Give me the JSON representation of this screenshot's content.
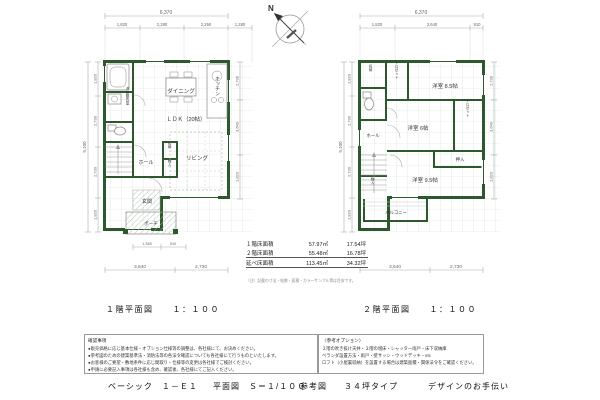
{
  "compass": {
    "label": "N"
  },
  "plan1": {
    "caption": "１階平面図　　１：１００",
    "rooms": {
      "dining": "ダイニング",
      "kitchen": "キッチン",
      "ldk": "ＬＤＫ（20帖）",
      "living": "リビング",
      "hall": "ホール",
      "entrance": "玄関",
      "porch": "ポーチ",
      "washroom": "洗面脱衣室",
      "storage1": "収納",
      "storage2": "物入"
    },
    "dims": {
      "top_total": "6,370",
      "top": [
        "1,820",
        "2,280",
        "2,250",
        "1,280"
      ],
      "left_total": "9,100",
      "left": [
        "1,820",
        "2,730",
        "2,730",
        "1,820"
      ],
      "right": [
        "2,730",
        "3,640",
        "1,820"
      ],
      "bottom_small": [
        "1,365",
        "910"
      ],
      "bottom": [
        "3,640",
        "2,730"
      ]
    }
  },
  "plan2": {
    "caption": "２階平面図　　１：１００",
    "rooms": {
      "room85": "洋室 8.5帖",
      "room6": "洋室 6帖",
      "room95": "洋室 9.5帖",
      "oshiire": "押入",
      "closet1": "クロゼット",
      "closet2": "クロゼット",
      "storage": "収納",
      "monoire": "物入",
      "balcony": "バルコニー",
      "hall": "ホール"
    },
    "dims": {
      "top_total": "6,370",
      "top": [
        "1,820",
        "3,640",
        "910"
      ],
      "left_total": "9,100",
      "left": [
        "1,820",
        "2,730",
        "2,730",
        "1,820"
      ],
      "right": [
        "2,730",
        "3,640",
        "1,820"
      ],
      "bottom": [
        "3,640",
        "2,730"
      ]
    }
  },
  "area_table": {
    "rows": [
      {
        "label": "１階床面積",
        "sqm": "57.97㎡",
        "tsubo": "17.54坪"
      },
      {
        "label": "２階床面積",
        "sqm": "55.48㎡",
        "tsubo": "16.78坪"
      }
    ],
    "total": {
      "label": "延べ床面積",
      "sqm": "113.45㎡",
      "tsubo": "34.32坪"
    },
    "note": "（注）記載の寸法・帖数・面積・カラーサンプル等は目安です。"
  },
  "notes_left": {
    "header": "確認事項",
    "items": [
      "●販売価格に応じ基本仕様・オプション仕様等の調整は、各社様にて、お決めください。",
      "●参考図のための建築基準法・消防法等の各法令確認についても各社様にて行うものといたします。",
      "●お客様のご要望・敷地条件に応じ間取り・仕様等の変更は各社様でご検討ください。",
      "●申請に必要記入事項は各社様も含め、確認後、各社様にてご記入ください。"
    ]
  },
  "notes_right": {
    "header": "〈参考オプション〉",
    "lines": [
      "２階の吹き抜け天井・２階の増床・シャッター雨戸・床下収納庫",
      "ベランダ設置方法・雨戸・壁サッシ・ウッドデッキ・etc",
      "ロフト（小屋裏収納）を設置する場合は建築面積・関係法令をご確認ください。"
    ]
  },
  "footer": {
    "items": [
      "ベーシック　１－Ｅ１",
      "平面図　Ｓ＝１/１００",
      "参考図",
      "３４坪タイプ",
      "デザインのお手伝い"
    ]
  },
  "colors": {
    "wall": "#2d572d",
    "grid": "#d4dfd4",
    "dim": "#999999"
  }
}
